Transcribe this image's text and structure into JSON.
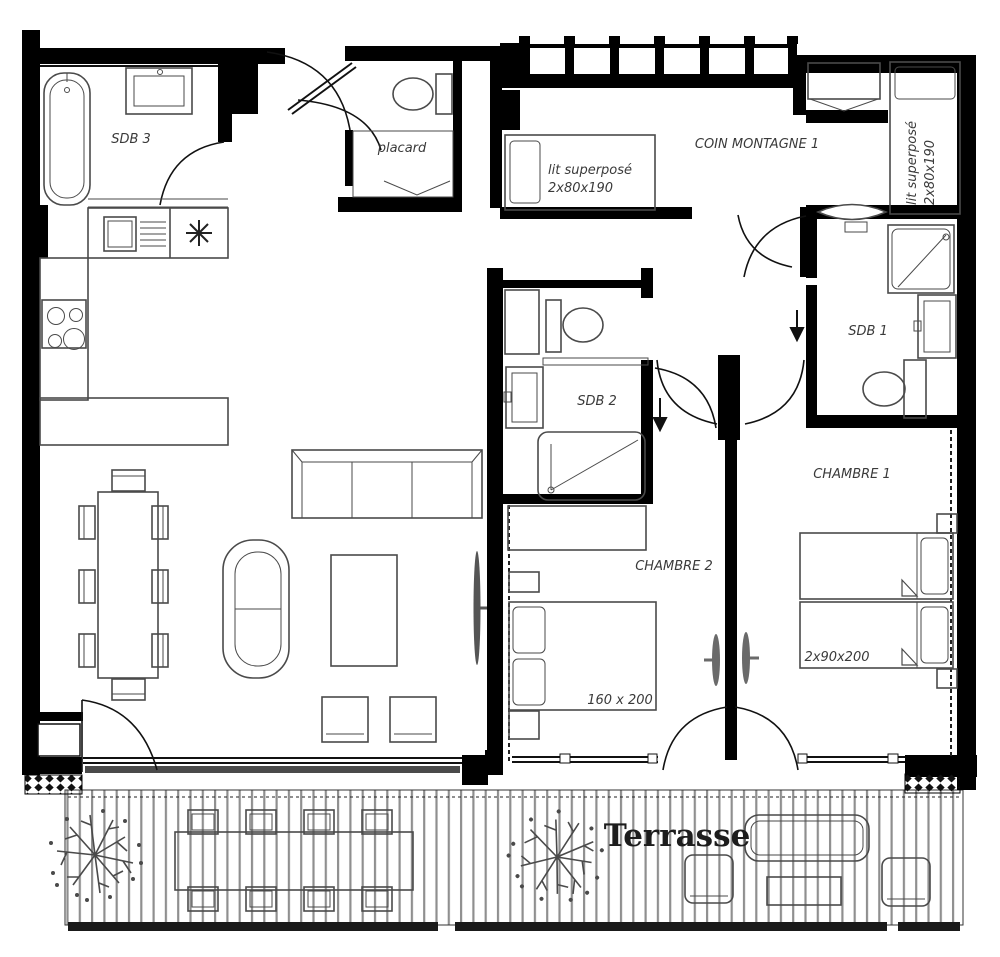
{
  "rooms": {
    "sdb3": "SDB 3",
    "placard": "placard",
    "coin_montagne_1": "COIN MONTAGNE 1",
    "sdb1": "SDB 1",
    "sdb2": "SDB 2",
    "chambre_1": "CHAMBRE 1",
    "chambre_2": "CHAMBRE 2",
    "terrasse": "Terrasse"
  },
  "furniture": {
    "bunk_left": {
      "line1": "lit superposé",
      "line2": "2x80x190"
    },
    "bunk_right": {
      "line1": "lit superposé",
      "line2": "2x80x190"
    },
    "bed_chambre2": {
      "size": "160 x 200"
    },
    "beds_chambre1": {
      "size": "2x90x200"
    }
  },
  "colors": {
    "wall": "#000000",
    "furniture_line": "#4a4a4a",
    "deck_line": "#8f8f8f",
    "label": "#3a3a3a"
  }
}
